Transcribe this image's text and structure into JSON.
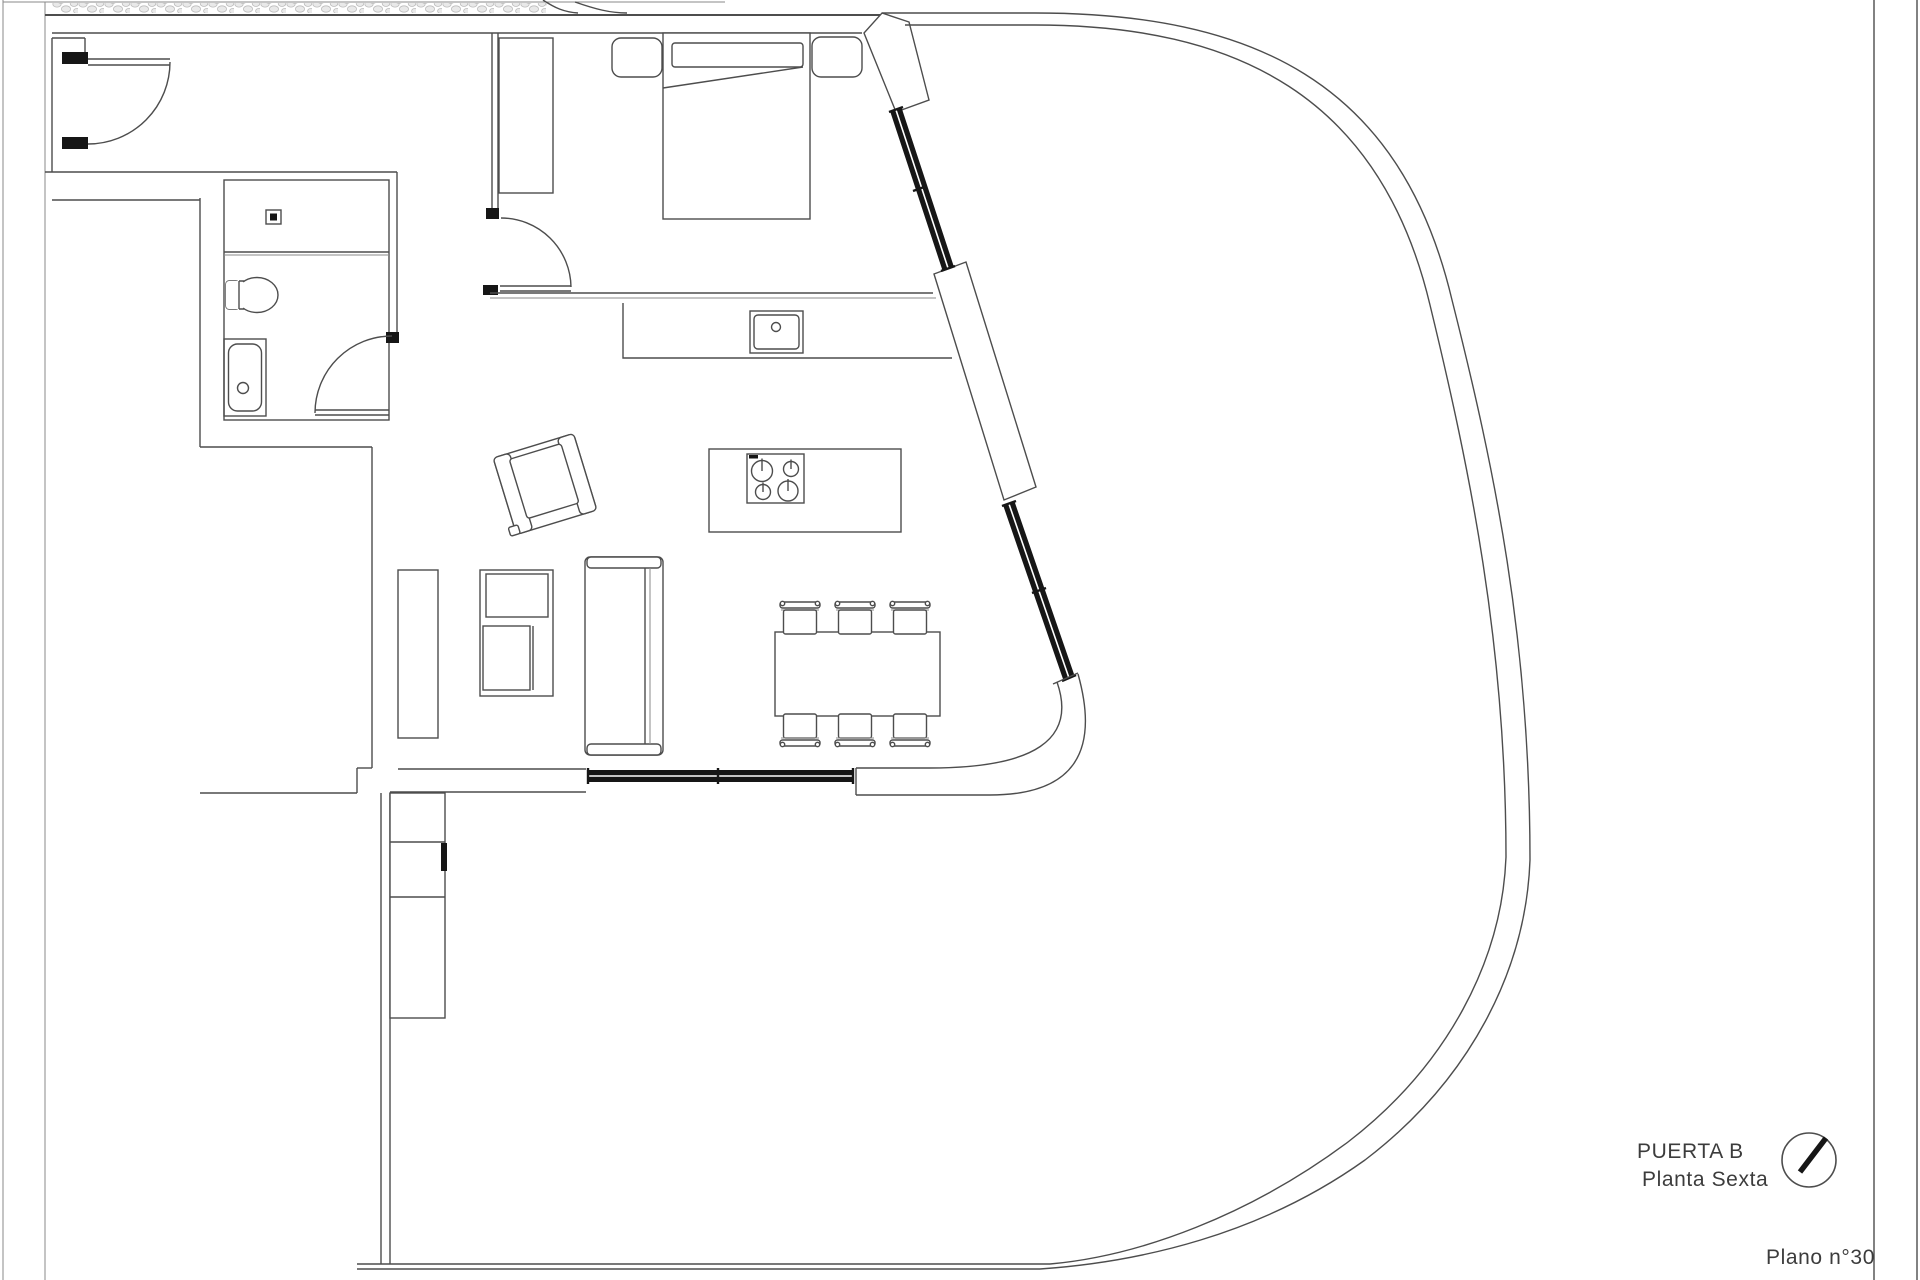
{
  "title_block": {
    "door_label": "PUERTA B",
    "floor_label": "Planta Sexta",
    "sheet_label": "Plano n°30"
  },
  "icons": {
    "north_indicator": "circle-with-diagonal-needle"
  },
  "colors": {
    "paper": "#ffffff",
    "line": "#4d4d4d",
    "lite": "#8a8a8a",
    "dark": "#161616",
    "text": "#3c3c3c",
    "hatch_stone": "#e9e9e9",
    "hatch_edge": "#bdbdbd"
  }
}
